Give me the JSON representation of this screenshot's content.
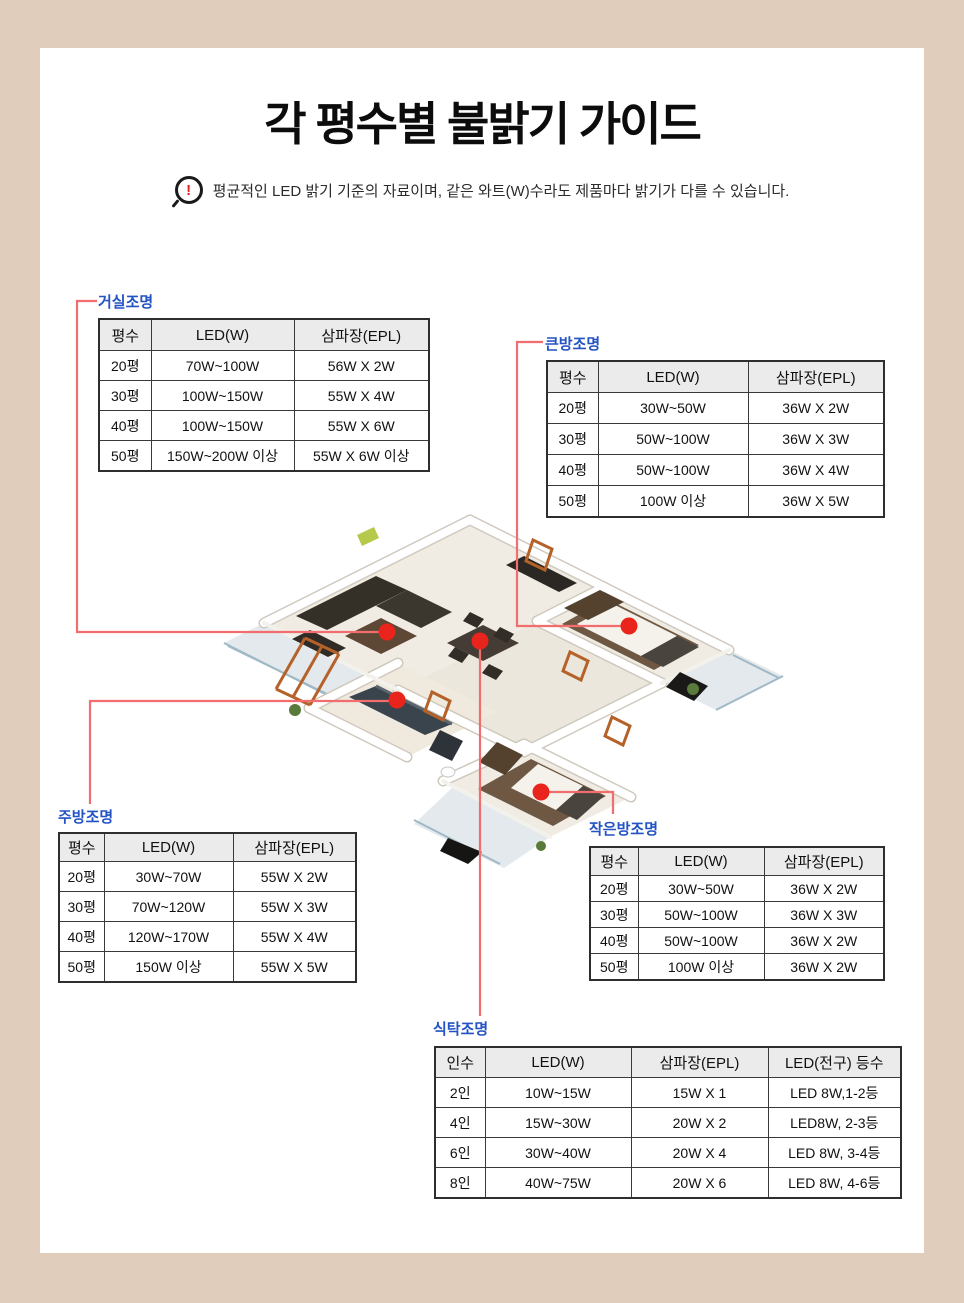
{
  "page": {
    "title": "각 평수별 불밝기 가이드",
    "notice": "평균적인 LED 밝기 기준의 자료이며, 같은 와트(W)수라도 제품마다 밝기가 다를 수 있습니다.",
    "colors": {
      "frame": "#e0cdbb",
      "background": "#ffffff",
      "callout_dot_red": "#e8241c",
      "callout_line_red": "#f26d6d",
      "label_blue": "#2353c4",
      "table_header_bg": "#ebebeb",
      "table_border": "#3a3a3a"
    },
    "icons": {
      "notice_icon": "magnifier-alert-icon"
    }
  },
  "tables": {
    "living": {
      "label": "거실조명",
      "headers": [
        "평수",
        "LED(W)",
        "삼파장(EPL)"
      ],
      "rows": [
        [
          "20평",
          "70W~100W",
          "56W X 2W"
        ],
        [
          "30평",
          "100W~150W",
          "55W X 4W"
        ],
        [
          "40평",
          "100W~150W",
          "55W X 6W"
        ],
        [
          "50평",
          "150W~200W 이상",
          "55W X 6W 이상"
        ]
      ]
    },
    "bigroom": {
      "label": "큰방조명",
      "headers": [
        "평수",
        "LED(W)",
        "삼파장(EPL)"
      ],
      "rows": [
        [
          "20평",
          "30W~50W",
          "36W X 2W"
        ],
        [
          "30평",
          "50W~100W",
          "36W X 3W"
        ],
        [
          "40평",
          "50W~100W",
          "36W X 4W"
        ],
        [
          "50평",
          "100W 이상",
          "36W X 5W"
        ]
      ]
    },
    "kitchen": {
      "label": "주방조명",
      "headers": [
        "평수",
        "LED(W)",
        "삼파장(EPL)"
      ],
      "rows": [
        [
          "20평",
          "30W~70W",
          "55W X 2W"
        ],
        [
          "30평",
          "70W~120W",
          "55W X 3W"
        ],
        [
          "40평",
          "120W~170W",
          "55W X 4W"
        ],
        [
          "50평",
          "150W 이상",
          "55W X 5W"
        ]
      ]
    },
    "smallroom": {
      "label": "작은방조명",
      "headers": [
        "평수",
        "LED(W)",
        "삼파장(EPL)"
      ],
      "rows": [
        [
          "20평",
          "30W~50W",
          "36W X 2W"
        ],
        [
          "30평",
          "50W~100W",
          "36W X 3W"
        ],
        [
          "40평",
          "50W~100W",
          "36W X 2W"
        ],
        [
          "50평",
          "100W 이상",
          "36W X 2W"
        ]
      ]
    },
    "dining": {
      "label": "식탁조명",
      "headers": [
        "인수",
        "LED(W)",
        "삼파장(EPL)",
        "LED(전구) 등수"
      ],
      "rows": [
        [
          "2인",
          "10W~15W",
          "15W X 1",
          "LED 8W,1-2등"
        ],
        [
          "4인",
          "15W~30W",
          "20W X 2",
          "LED8W, 2-3등"
        ],
        [
          "6인",
          "30W~40W",
          "20W X 4",
          "LED 8W, 3-4등"
        ],
        [
          "8인",
          "40W~75W",
          "20W X 6",
          "LED 8W, 4-6등"
        ]
      ]
    }
  }
}
